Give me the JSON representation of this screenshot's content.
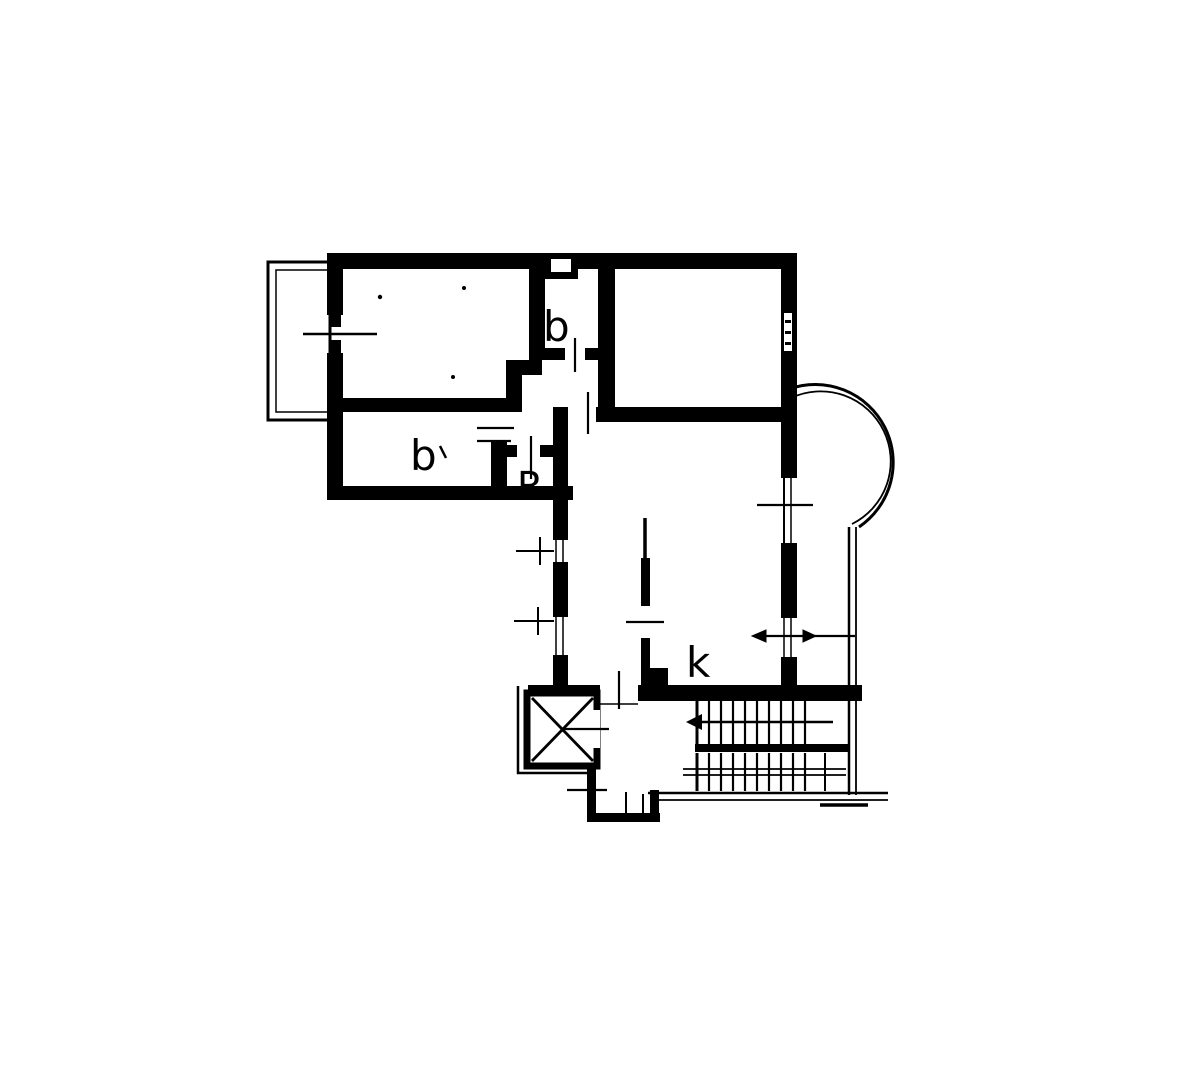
{
  "document": {
    "type": "floor-plan",
    "description": "scanned black-and-white apartment floor plan"
  },
  "colors": {
    "ink": "#000000",
    "paper": "#ffffff"
  },
  "rooms": [
    {
      "id": "bathroom-top",
      "label": "b"
    },
    {
      "id": "bathroom-lower-left",
      "label": "b"
    },
    {
      "id": "storage-closet",
      "label": "R"
    },
    {
      "id": "kitchen",
      "label": "k"
    }
  ],
  "symbols": {
    "elevator": "x-crossed-box",
    "staircase": "two-flights-with-treads",
    "stair_arrow_direction": "left",
    "round_balcony": "semicircular-bay-right-side",
    "left_balcony": "rectangular-balcony-top-left",
    "opening_marks": "tick-cross-lines-for-doors-and-windows"
  }
}
